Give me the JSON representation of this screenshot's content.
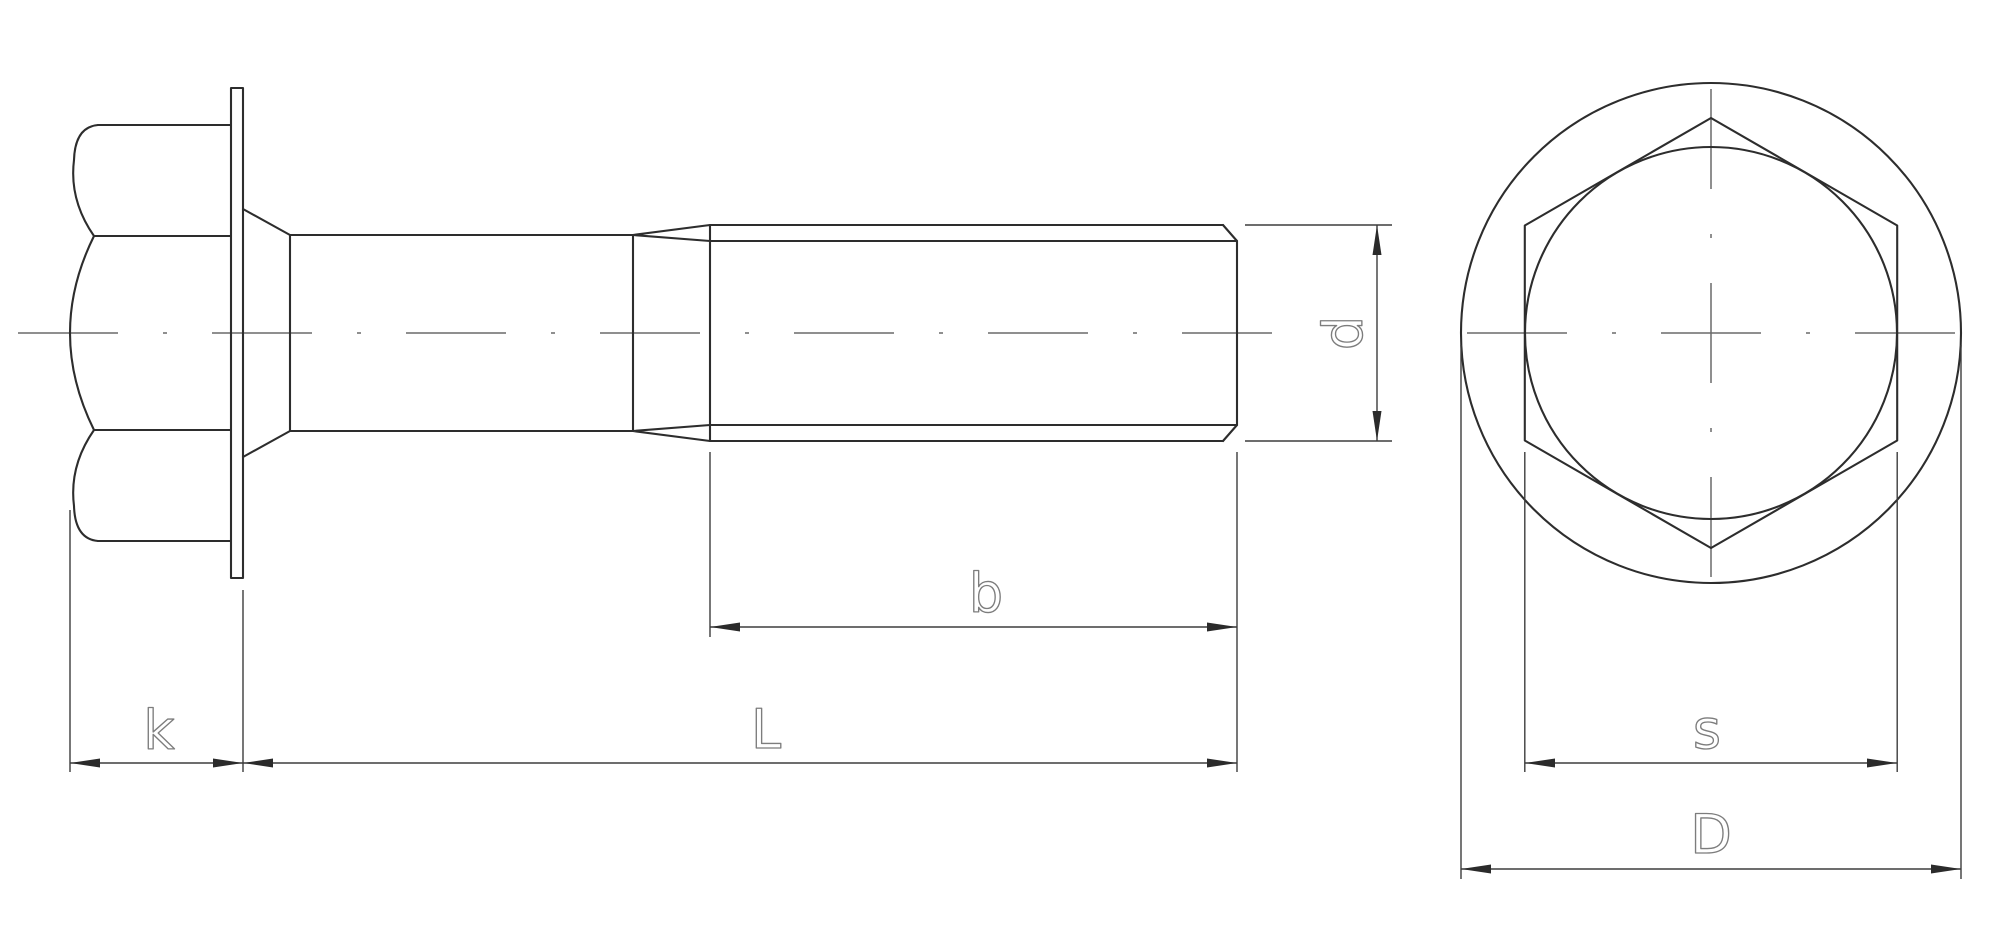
{
  "drawing": {
    "kind": "engineering-drawing",
    "subject": "hex-flange-bolt",
    "labels": {
      "k": "k",
      "L": "L",
      "b": "b",
      "d": "d",
      "s": "s",
      "D": "D"
    }
  },
  "colors": {
    "background": "#ffffff",
    "object_line": "#2d2d2d",
    "dimension_line": "#3d3d3d",
    "centerline": "#6a6a6a",
    "label_text": "#7d7d7d",
    "arrow_fill": "#2b2b2b"
  }
}
